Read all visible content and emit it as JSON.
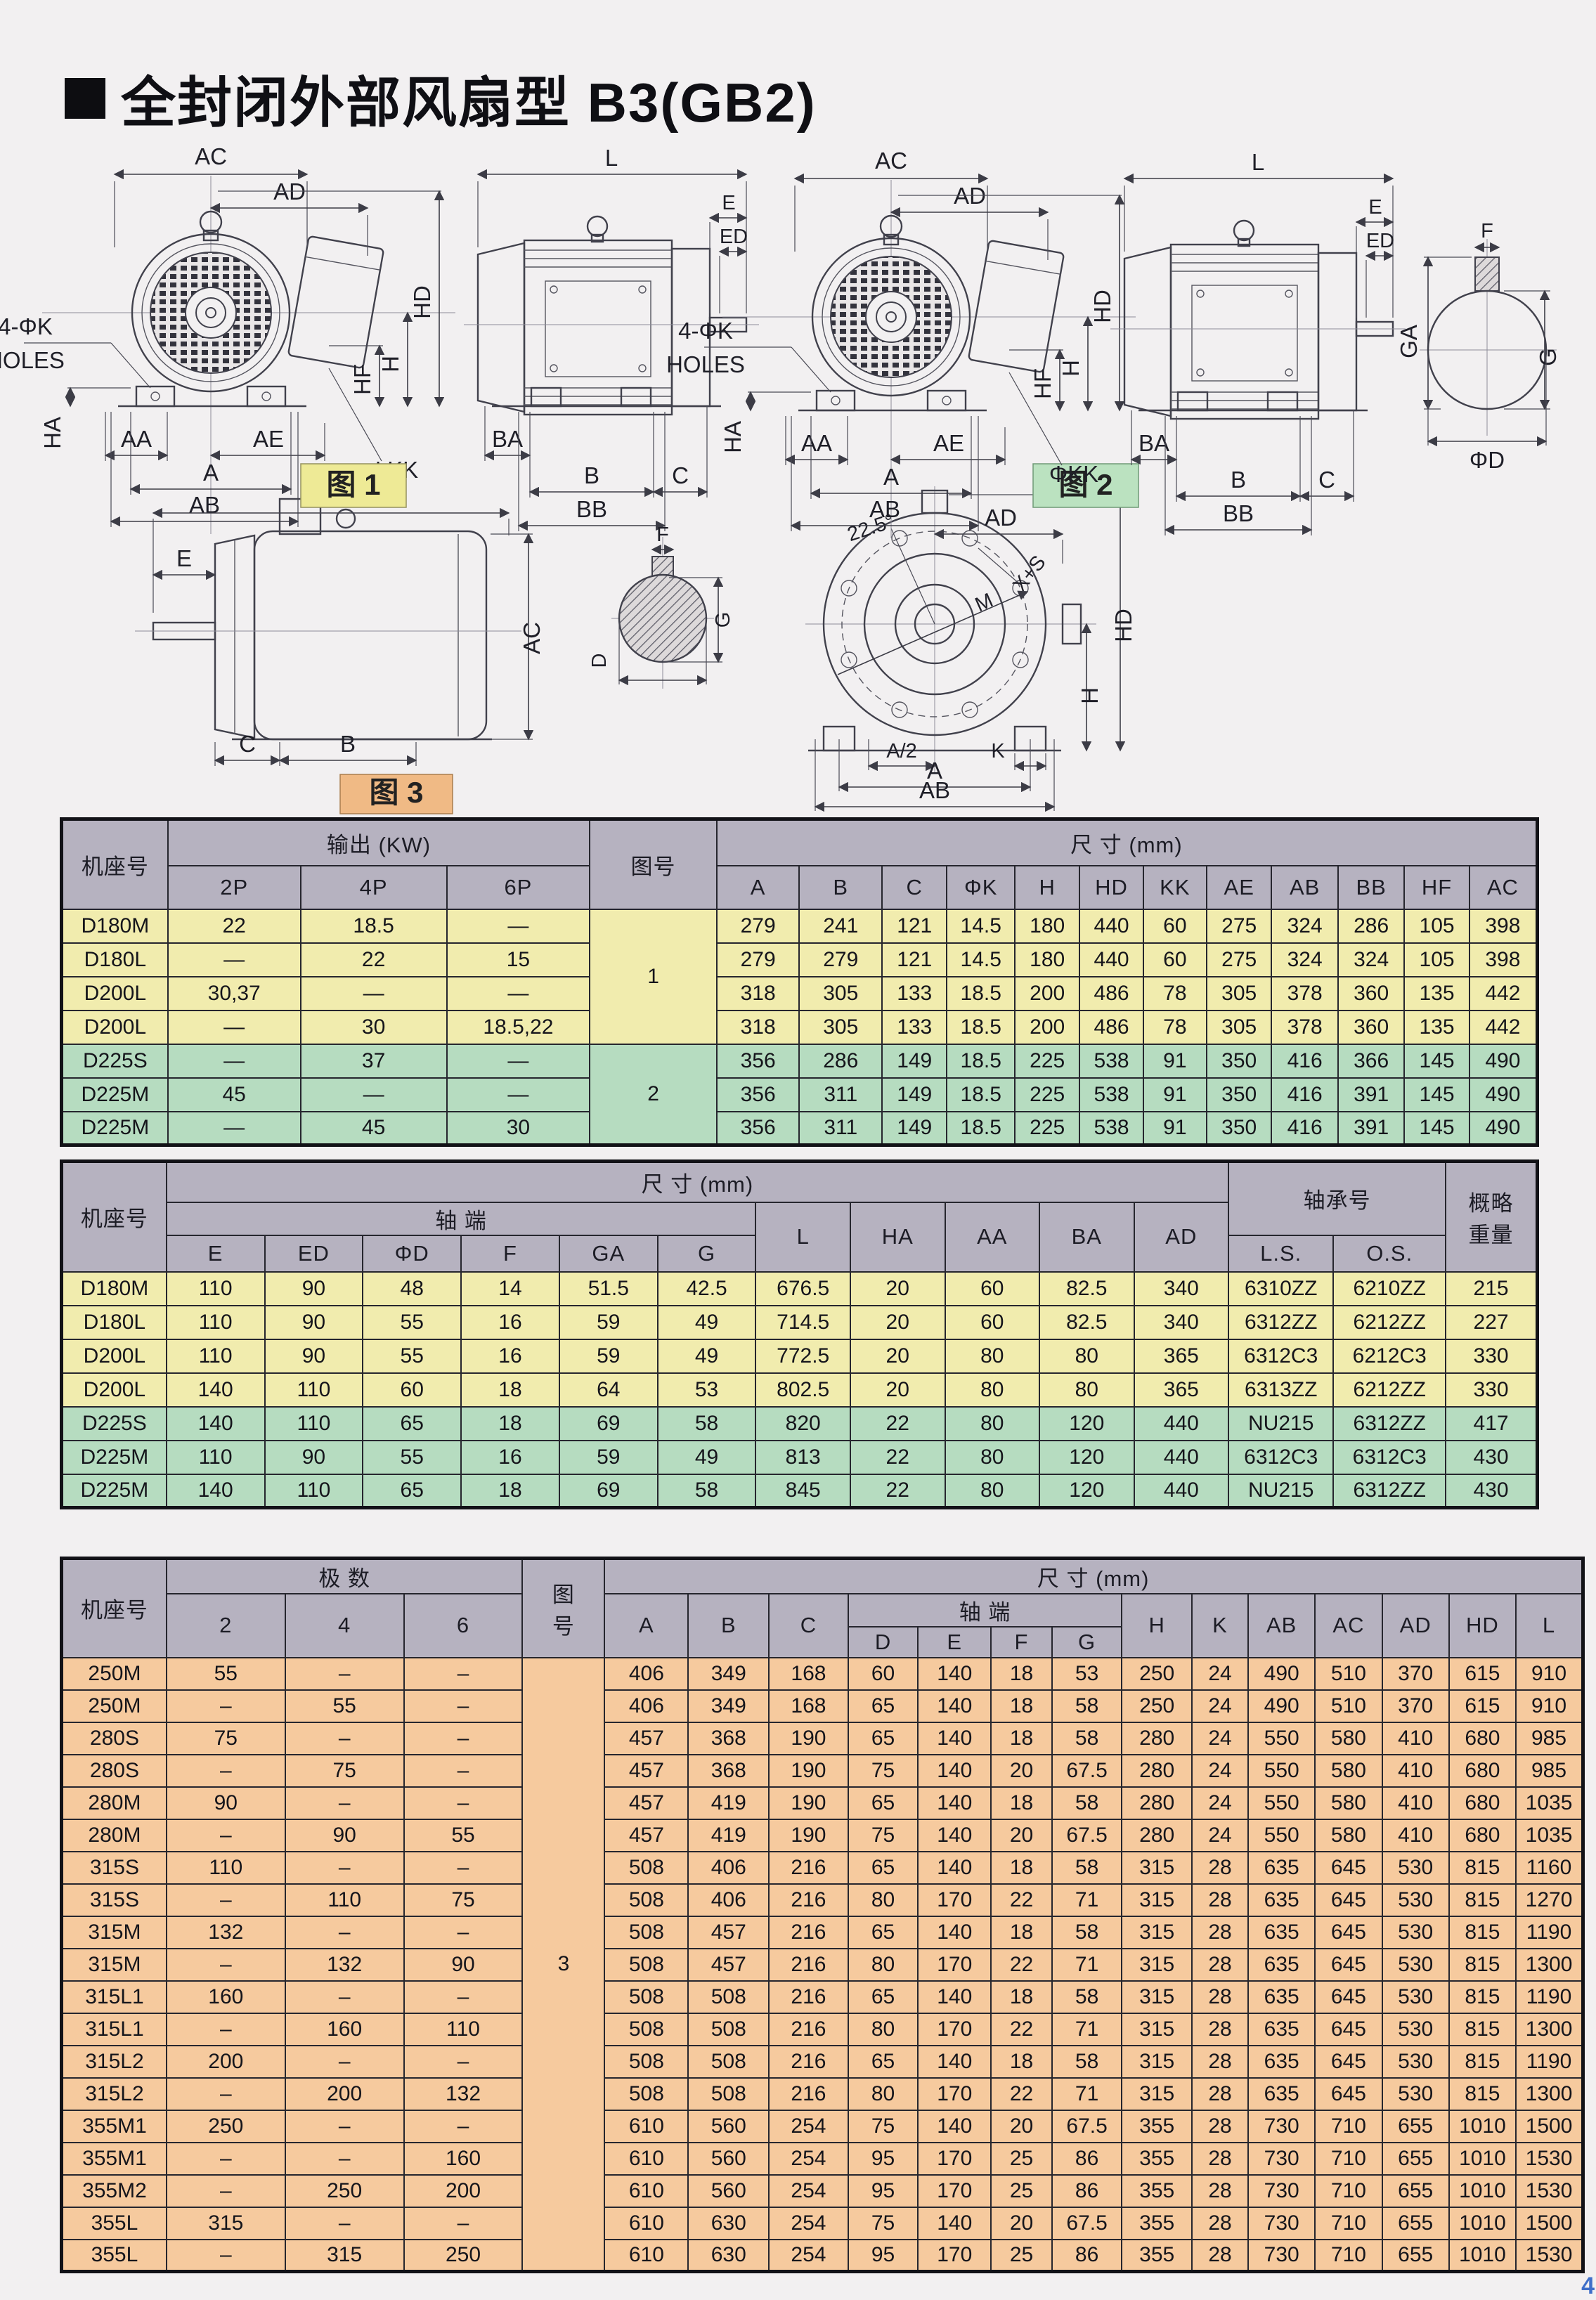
{
  "page": {
    "title_bullet": "■",
    "title": "全封闭外部风扇型 B3(GB2)",
    "page_number": "4"
  },
  "colors": {
    "header_gray": "#b6b2c0",
    "row_yellow": "#f1ecae",
    "row_green": "#b6dcc0",
    "row_peach": "#f6ca9e",
    "badge_yellow": "#eeea96",
    "badge_green": "#bbe2c0",
    "badge_peach": "#f0ba85",
    "page_bg": "#f2f0f1",
    "page_number_blue": "#3f6fc9"
  },
  "figures": {
    "labels": {
      "ac": "AC",
      "ad": "AD",
      "hd": "HD",
      "h": "H",
      "hf": "HF",
      "phikk": "ΦKK",
      "holes1": "4-ΦK",
      "holes2": "HOLES",
      "ha": "HA",
      "aa": "AA",
      "ae": "AE",
      "a": "A",
      "ab": "AB",
      "l": "L",
      "e": "E",
      "ed": "ED",
      "ba": "BA",
      "b": "B",
      "c": "C",
      "bb": "BB",
      "f": "F",
      "ga": "GA",
      "g": "G",
      "phid": "ΦD",
      "d": "D",
      "angle": "22.5°",
      "xs": "X+S",
      "m": "M",
      "a_half": "A/2",
      "k": "K",
      "fig1": "图 1",
      "fig2": "图 2",
      "fig3": "图 3"
    }
  },
  "tables": {
    "t1": {
      "col_widths": [
        7.2,
        9.0,
        9.9,
        9.7,
        8.6,
        5.6,
        5.6,
        4.4,
        4.6,
        4.4,
        4.3,
        4.3,
        4.4,
        4.5,
        4.5,
        4.4,
        4.6
      ],
      "header_rows": [
        [
          {
            "label": "机座号",
            "rowspan": 2
          },
          {
            "label": "输出 (KW)",
            "colspan": 3
          },
          {
            "label": "图号",
            "rowspan": 2
          },
          {
            "label": "尺 寸 (mm)",
            "colspan": 12
          }
        ],
        [
          {
            "label": "2P"
          },
          {
            "label": "4P"
          },
          {
            "label": "6P"
          },
          {
            "label": "A"
          },
          {
            "label": "B"
          },
          {
            "label": "C"
          },
          {
            "label": "ΦK"
          },
          {
            "label": "H"
          },
          {
            "label": "HD"
          },
          {
            "label": "KK"
          },
          {
            "label": "AE"
          },
          {
            "label": "AB"
          },
          {
            "label": "BB"
          },
          {
            "label": "HF"
          },
          {
            "label": "AC"
          }
        ]
      ],
      "rows": [
        [
          "D180M",
          "22",
          "18.5",
          "—",
          {
            "v": "1",
            "rs": 4
          },
          "279",
          "241",
          "121",
          "14.5",
          "180",
          "440",
          "60",
          "275",
          "324",
          "286",
          "105",
          "398"
        ],
        [
          "D180L",
          "—",
          "22",
          "15",
          "279",
          "279",
          "121",
          "14.5",
          "180",
          "440",
          "60",
          "275",
          "324",
          "324",
          "105",
          "398"
        ],
        [
          "D200L",
          "30,37",
          "—",
          "—",
          "318",
          "305",
          "133",
          "18.5",
          "200",
          "486",
          "78",
          "305",
          "378",
          "360",
          "135",
          "442"
        ],
        [
          "D200L",
          "—",
          "30",
          "18.5,22",
          "318",
          "305",
          "133",
          "18.5",
          "200",
          "486",
          "78",
          "305",
          "378",
          "360",
          "135",
          "442"
        ],
        [
          "D225S",
          "—",
          "37",
          "—",
          {
            "v": "2",
            "rs": 3
          },
          "356",
          "286",
          "149",
          "18.5",
          "225",
          "538",
          "91",
          "350",
          "416",
          "366",
          "145",
          "490"
        ],
        [
          "D225M",
          "45",
          "—",
          "—",
          "356",
          "311",
          "149",
          "18.5",
          "225",
          "538",
          "91",
          "350",
          "416",
          "391",
          "145",
          "490"
        ],
        [
          "D225M",
          "—",
          "45",
          "30",
          "356",
          "311",
          "149",
          "18.5",
          "225",
          "538",
          "91",
          "350",
          "416",
          "391",
          "145",
          "490"
        ]
      ],
      "row_colors": [
        "row_yellow",
        "row_yellow",
        "row_yellow",
        "row_yellow",
        "row_green",
        "row_green",
        "row_green"
      ]
    },
    "t2": {
      "col_widths": [
        7.1,
        6.65,
        6.65,
        6.65,
        6.65,
        6.65,
        6.65,
        6.4,
        6.4,
        6.4,
        6.4,
        6.4,
        7.1,
        7.6,
        6.2
      ],
      "header_rows": [
        [
          {
            "label": "机座号",
            "rowspan": 3
          },
          {
            "label": "尺 寸 (mm)",
            "colspan": 11
          },
          {
            "label": "轴承号",
            "colspan": 2,
            "rowspan": 2
          },
          {
            "label": "概略\n重量",
            "rowspan": 3
          }
        ],
        [
          {
            "label": "轴 端",
            "colspan": 6
          },
          {
            "label": "L",
            "rowspan": 2
          },
          {
            "label": "HA",
            "rowspan": 2
          },
          {
            "label": "AA",
            "rowspan": 2
          },
          {
            "label": "BA",
            "rowspan": 2
          },
          {
            "label": "AD",
            "rowspan": 2
          }
        ],
        [
          {
            "label": "E"
          },
          {
            "label": "ED"
          },
          {
            "label": "ΦD"
          },
          {
            "label": "F"
          },
          {
            "label": "GA"
          },
          {
            "label": "G"
          },
          {
            "label": "L.S."
          },
          {
            "label": "O.S."
          }
        ]
      ],
      "rows": [
        [
          "D180M",
          "110",
          "90",
          "48",
          "14",
          "51.5",
          "42.5",
          "676.5",
          "20",
          "60",
          "82.5",
          "340",
          "6310ZZ",
          "6210ZZ",
          "215"
        ],
        [
          "D180L",
          "110",
          "90",
          "55",
          "16",
          "59",
          "49",
          "714.5",
          "20",
          "60",
          "82.5",
          "340",
          "6312ZZ",
          "6212ZZ",
          "227"
        ],
        [
          "D200L",
          "110",
          "90",
          "55",
          "16",
          "59",
          "49",
          "772.5",
          "20",
          "80",
          "80",
          "365",
          "6312C3",
          "6212C3",
          "330"
        ],
        [
          "D200L",
          "140",
          "110",
          "60",
          "18",
          "64",
          "53",
          "802.5",
          "20",
          "80",
          "80",
          "365",
          "6313ZZ",
          "6212ZZ",
          "330"
        ],
        [
          "D225S",
          "140",
          "110",
          "65",
          "18",
          "69",
          "58",
          "820",
          "22",
          "80",
          "120",
          "440",
          "NU215",
          "6312ZZ",
          "417"
        ],
        [
          "D225M",
          "110",
          "90",
          "55",
          "16",
          "59",
          "49",
          "813",
          "22",
          "80",
          "120",
          "440",
          "6312C3",
          "6312C3",
          "430"
        ],
        [
          "D225M",
          "140",
          "110",
          "65",
          "18",
          "69",
          "58",
          "845",
          "22",
          "80",
          "120",
          "440",
          "NU215",
          "6312ZZ",
          "430"
        ]
      ],
      "row_colors": [
        "row_yellow",
        "row_yellow",
        "row_yellow",
        "row_yellow",
        "row_green",
        "row_green",
        "row_green"
      ]
    },
    "t3": {
      "col_widths": [
        6.9,
        7.8,
        7.8,
        7.8,
        5.4,
        5.5,
        5.3,
        5.2,
        4.6,
        4.8,
        4.0,
        4.6,
        4.6,
        3.7,
        4.4,
        4.4,
        4.4,
        4.4,
        4.4
      ],
      "header_rows": [
        [
          {
            "label": "机座号",
            "rowspan": 3
          },
          {
            "label": "极 数",
            "colspan": 3
          },
          {
            "label": "图\n号",
            "rowspan": 3
          },
          {
            "label": "尺 寸 (mm)",
            "colspan": 14
          }
        ],
        [
          {
            "label": "2",
            "rowspan": 2
          },
          {
            "label": "4",
            "rowspan": 2
          },
          {
            "label": "6",
            "rowspan": 2
          },
          {
            "label": "A",
            "rowspan": 2
          },
          {
            "label": "B",
            "rowspan": 2
          },
          {
            "label": "C",
            "rowspan": 2
          },
          {
            "label": "轴 端",
            "colspan": 4
          },
          {
            "label": "H",
            "rowspan": 2
          },
          {
            "label": "K",
            "rowspan": 2
          },
          {
            "label": "AB",
            "rowspan": 2
          },
          {
            "label": "AC",
            "rowspan": 2
          },
          {
            "label": "AD",
            "rowspan": 2
          },
          {
            "label": "HD",
            "rowspan": 2
          },
          {
            "label": "L",
            "rowspan": 2
          }
        ],
        [
          {
            "label": "D"
          },
          {
            "label": "E"
          },
          {
            "label": "F"
          },
          {
            "label": "G"
          }
        ]
      ],
      "rows": [
        [
          "250M",
          "55",
          "–",
          "–",
          {
            "v": "3",
            "rs": 19
          },
          "406",
          "349",
          "168",
          "60",
          "140",
          "18",
          "53",
          "250",
          "24",
          "490",
          "510",
          "370",
          "615",
          "910"
        ],
        [
          "250M",
          "–",
          "55",
          "–",
          "406",
          "349",
          "168",
          "65",
          "140",
          "18",
          "58",
          "250",
          "24",
          "490",
          "510",
          "370",
          "615",
          "910"
        ],
        [
          "280S",
          "75",
          "–",
          "–",
          "457",
          "368",
          "190",
          "65",
          "140",
          "18",
          "58",
          "280",
          "24",
          "550",
          "580",
          "410",
          "680",
          "985"
        ],
        [
          "280S",
          "–",
          "75",
          "–",
          "457",
          "368",
          "190",
          "75",
          "140",
          "20",
          "67.5",
          "280",
          "24",
          "550",
          "580",
          "410",
          "680",
          "985"
        ],
        [
          "280M",
          "90",
          "–",
          "–",
          "457",
          "419",
          "190",
          "65",
          "140",
          "18",
          "58",
          "280",
          "24",
          "550",
          "580",
          "410",
          "680",
          "1035"
        ],
        [
          "280M",
          "–",
          "90",
          "55",
          "457",
          "419",
          "190",
          "75",
          "140",
          "20",
          "67.5",
          "280",
          "24",
          "550",
          "580",
          "410",
          "680",
          "1035"
        ],
        [
          "315S",
          "110",
          "–",
          "–",
          "508",
          "406",
          "216",
          "65",
          "140",
          "18",
          "58",
          "315",
          "28",
          "635",
          "645",
          "530",
          "815",
          "1160"
        ],
        [
          "315S",
          "–",
          "110",
          "75",
          "508",
          "406",
          "216",
          "80",
          "170",
          "22",
          "71",
          "315",
          "28",
          "635",
          "645",
          "530",
          "815",
          "1270"
        ],
        [
          "315M",
          "132",
          "–",
          "–",
          "508",
          "457",
          "216",
          "65",
          "140",
          "18",
          "58",
          "315",
          "28",
          "635",
          "645",
          "530",
          "815",
          "1190"
        ],
        [
          "315M",
          "–",
          "132",
          "90",
          "508",
          "457",
          "216",
          "80",
          "170",
          "22",
          "71",
          "315",
          "28",
          "635",
          "645",
          "530",
          "815",
          "1300"
        ],
        [
          "315L1",
          "160",
          "–",
          "–",
          "508",
          "508",
          "216",
          "65",
          "140",
          "18",
          "58",
          "315",
          "28",
          "635",
          "645",
          "530",
          "815",
          "1190"
        ],
        [
          "315L1",
          "–",
          "160",
          "110",
          "508",
          "508",
          "216",
          "80",
          "170",
          "22",
          "71",
          "315",
          "28",
          "635",
          "645",
          "530",
          "815",
          "1300"
        ],
        [
          "315L2",
          "200",
          "–",
          "–",
          "508",
          "508",
          "216",
          "65",
          "140",
          "18",
          "58",
          "315",
          "28",
          "635",
          "645",
          "530",
          "815",
          "1190"
        ],
        [
          "315L2",
          "–",
          "200",
          "132",
          "508",
          "508",
          "216",
          "80",
          "170",
          "22",
          "71",
          "315",
          "28",
          "635",
          "645",
          "530",
          "815",
          "1300"
        ],
        [
          "355M1",
          "250",
          "–",
          "–",
          "610",
          "560",
          "254",
          "75",
          "140",
          "20",
          "67.5",
          "355",
          "28",
          "730",
          "710",
          "655",
          "1010",
          "1500"
        ],
        [
          "355M1",
          "–",
          "–",
          "160",
          "610",
          "560",
          "254",
          "95",
          "170",
          "25",
          "86",
          "355",
          "28",
          "730",
          "710",
          "655",
          "1010",
          "1530"
        ],
        [
          "355M2",
          "–",
          "250",
          "200",
          "610",
          "560",
          "254",
          "95",
          "170",
          "25",
          "86",
          "355",
          "28",
          "730",
          "710",
          "655",
          "1010",
          "1530"
        ],
        [
          "355L",
          "315",
          "–",
          "–",
          "610",
          "630",
          "254",
          "75",
          "140",
          "20",
          "67.5",
          "355",
          "28",
          "730",
          "710",
          "655",
          "1010",
          "1500"
        ],
        [
          "355L",
          "–",
          "315",
          "250",
          "610",
          "630",
          "254",
          "95",
          "170",
          "25",
          "86",
          "355",
          "28",
          "730",
          "710",
          "655",
          "1010",
          "1530"
        ]
      ],
      "row_colors": [
        "row_peach",
        "row_peach",
        "row_peach",
        "row_peach",
        "row_peach",
        "row_peach",
        "row_peach",
        "row_peach",
        "row_peach",
        "row_peach",
        "row_peach",
        "row_peach",
        "row_peach",
        "row_peach",
        "row_peach",
        "row_peach",
        "row_peach",
        "row_peach",
        "row_peach"
      ]
    }
  }
}
